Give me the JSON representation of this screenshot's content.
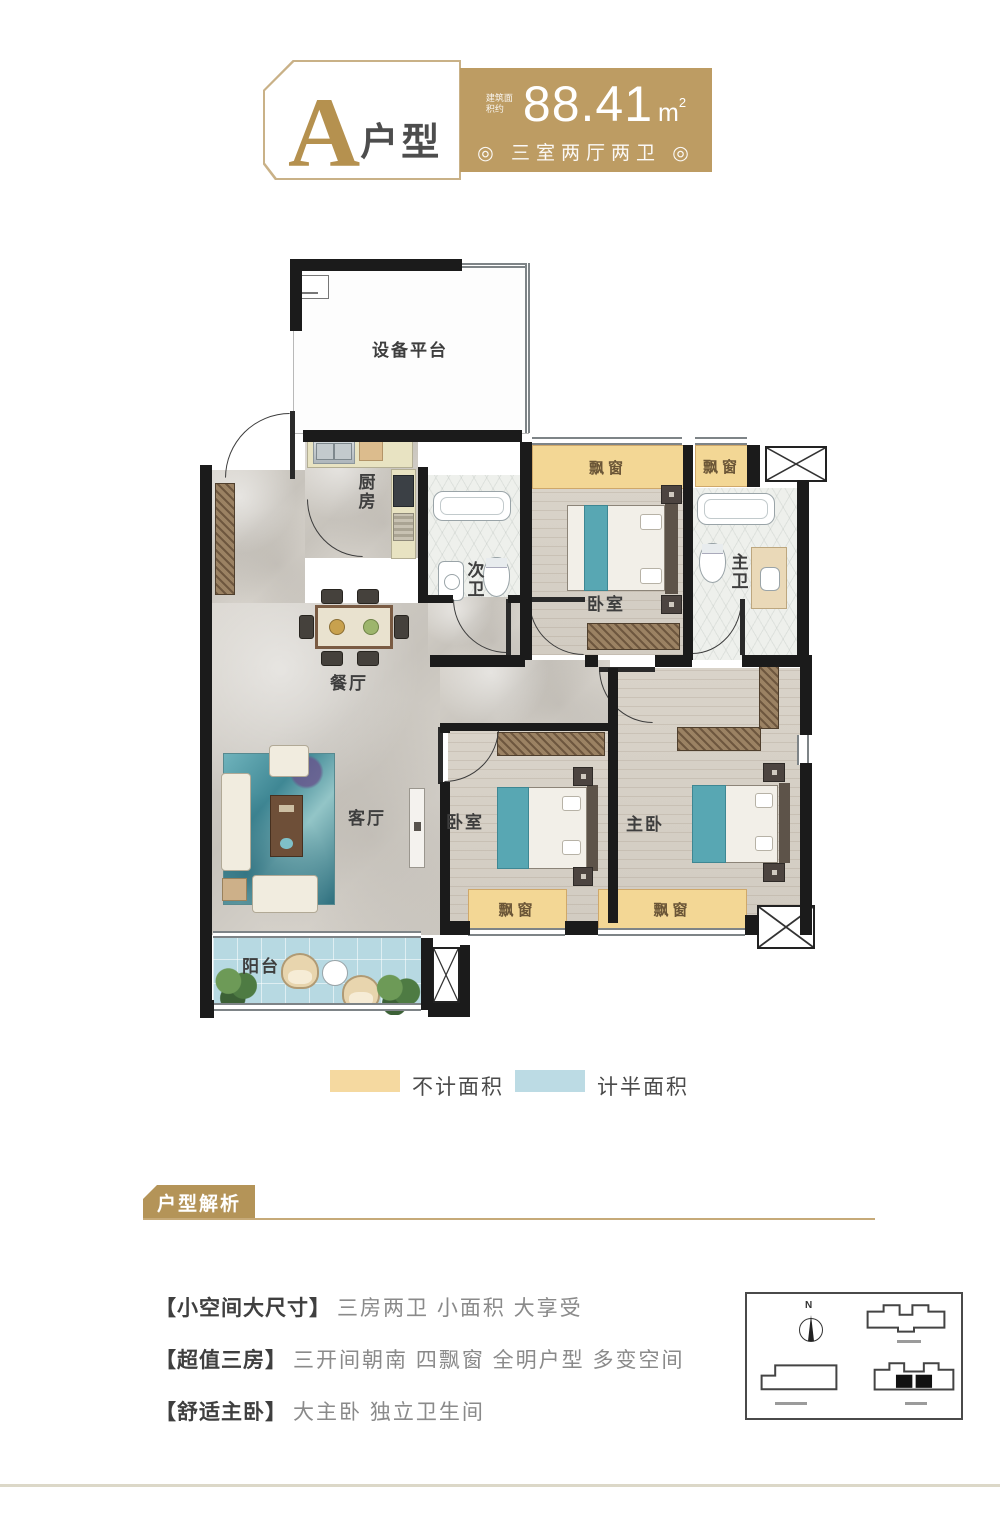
{
  "header": {
    "type_letter": "A",
    "type_suffix": "户型",
    "area_prefix": "建筑面积约",
    "area_value": "88.41",
    "area_unit": "m",
    "area_sup": "2",
    "layout_line": "◎ 三室两厅两卫 ◎"
  },
  "plan": {
    "bay": "飘窗",
    "rooms": {
      "equipment": "设备平台",
      "kitchen": "厨房",
      "second_bath": "次卫",
      "bedroom_top": "卧室",
      "master_bath": "主卫",
      "dining": "餐厅",
      "living": "客厅",
      "bedroom_bottom": "卧室",
      "master_bedroom": "主卧",
      "balcony": "阳台"
    }
  },
  "legend": {
    "items": [
      {
        "label": "不计面积",
        "color": "#f5d9a0"
      },
      {
        "label": "计半面积",
        "color": "#bcdbe4"
      }
    ]
  },
  "analysis": {
    "title": "户型解析",
    "points": [
      {
        "head": "【小空间大尺寸】",
        "body": "三房两卫 小面积 大享受"
      },
      {
        "head": "【超值三房】",
        "body": "三开间朝南 四飘窗 全明户型 多变空间"
      },
      {
        "head": "【舒适主卧】",
        "body": "大主卧 独立卫生间"
      }
    ]
  },
  "site_map": {
    "north_label": "N"
  },
  "colors": {
    "gold": "#bd9c63",
    "tag_gold": "#b49458",
    "bay_yellow": "#f3d795",
    "balcony_blue": "#b7d9e2",
    "bed_teal": "#58a7b3",
    "wall_black": "#1b1b1b"
  }
}
